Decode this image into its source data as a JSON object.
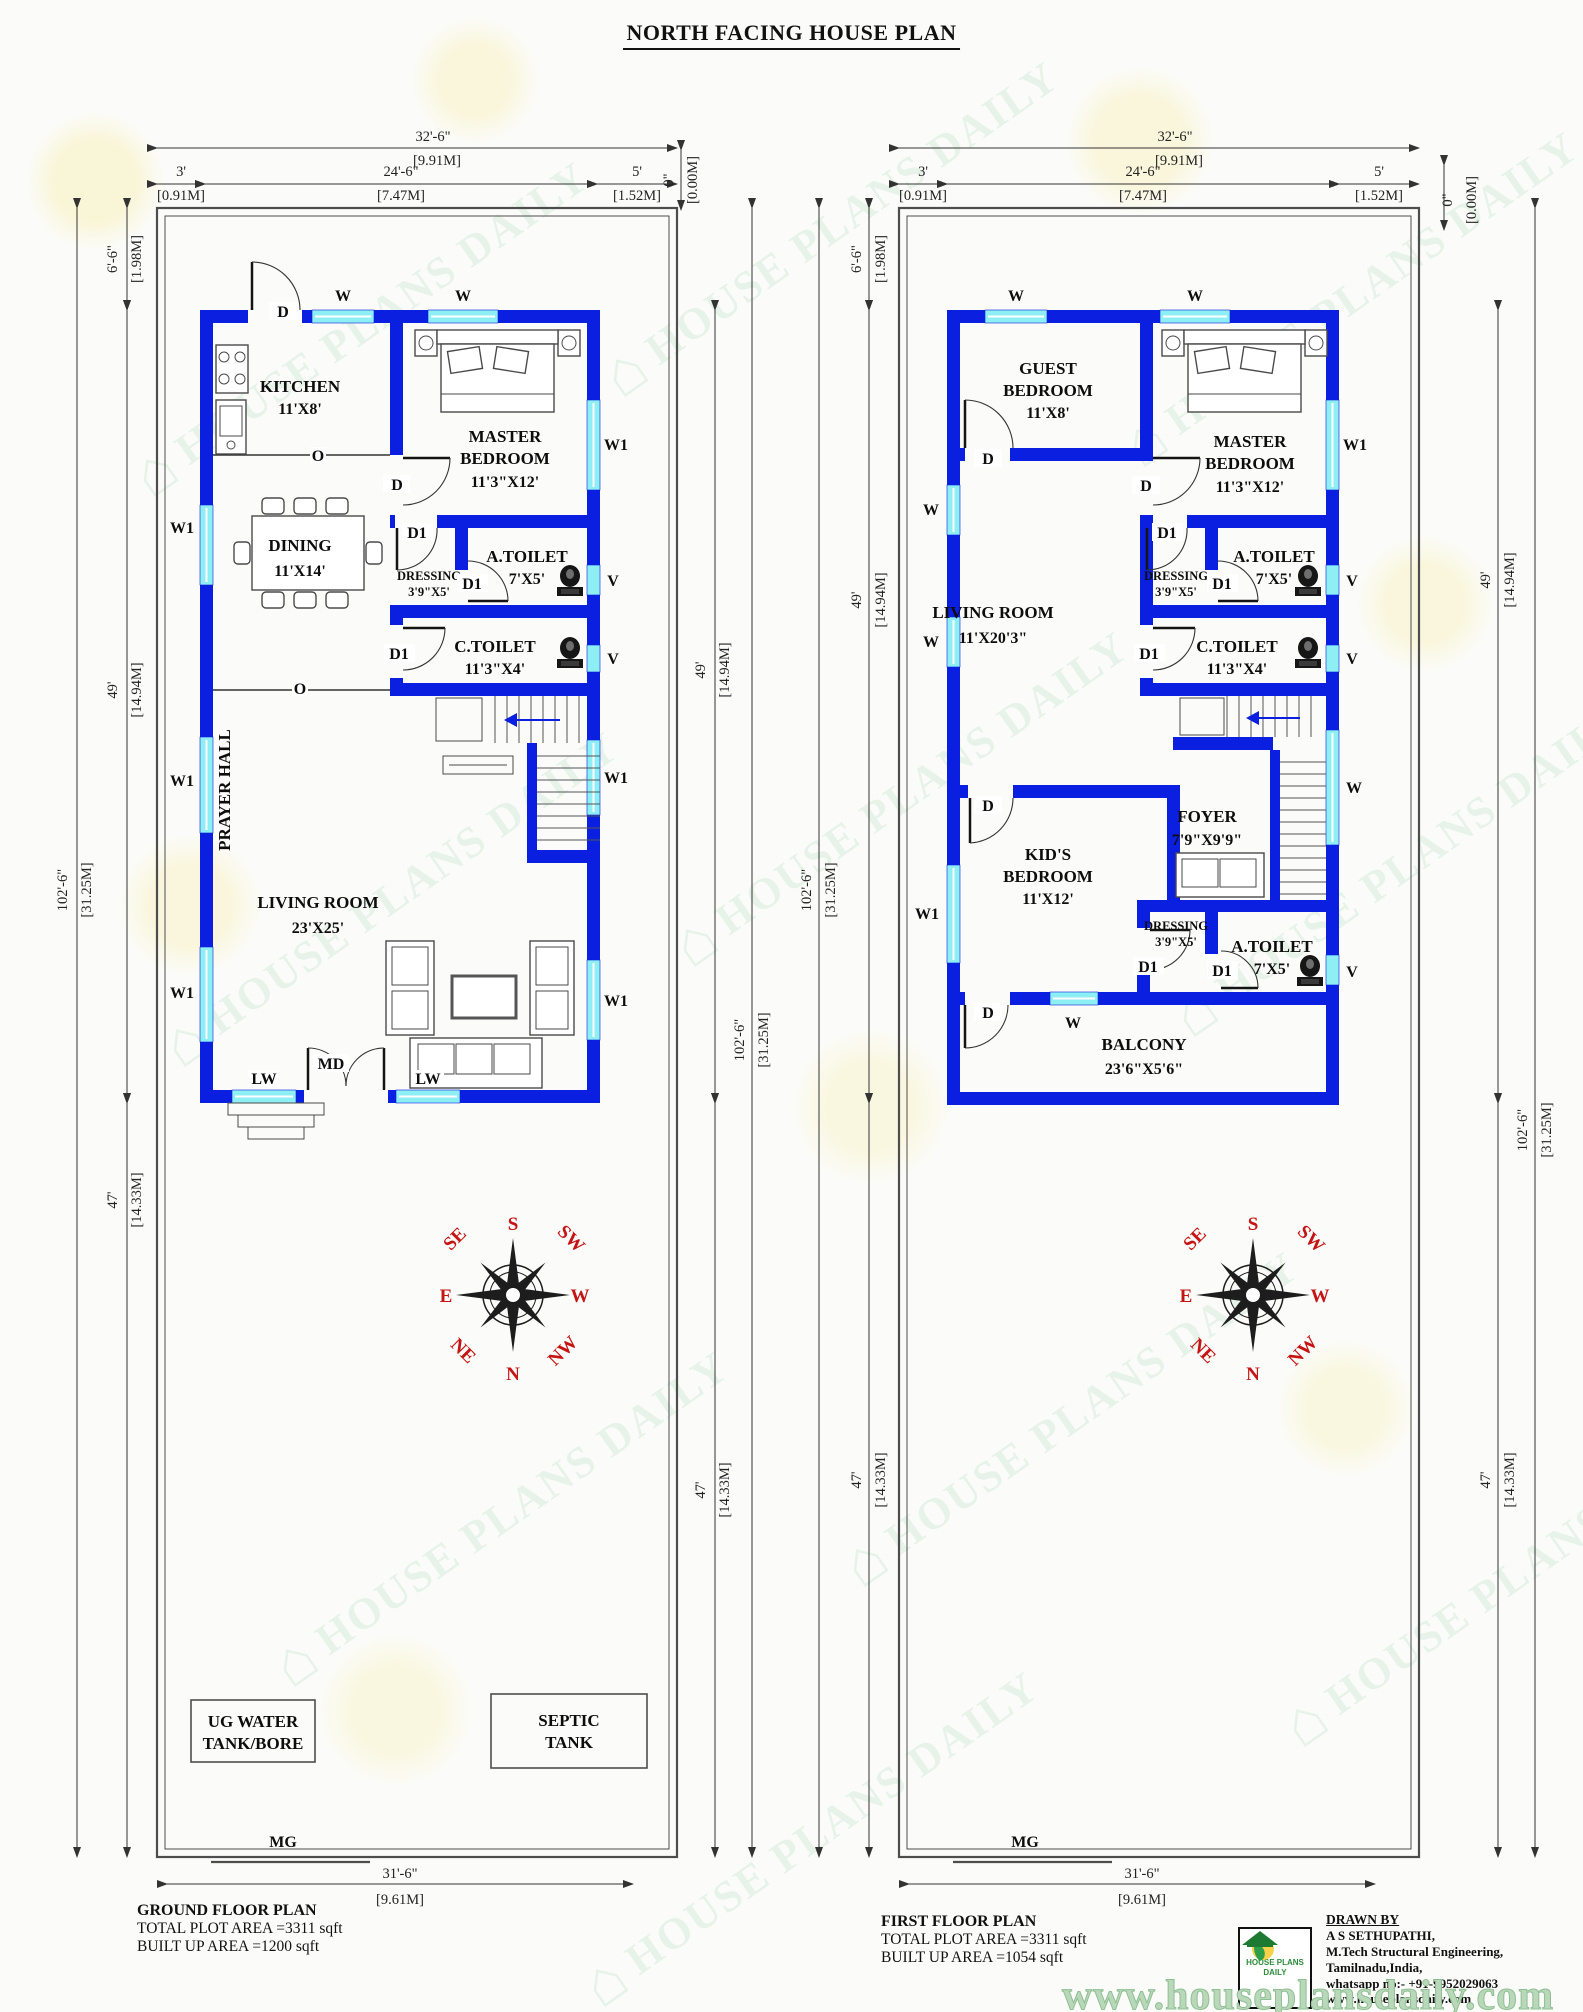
{
  "title": "NORTH FACING HOUSE PLAN",
  "colors": {
    "wall": "#0a1fe0",
    "win": "#8deef3",
    "compass": "#c41414",
    "brand": "#2f9e52",
    "bg": "#fbfcfa"
  },
  "icons": {
    "house": "⌂"
  },
  "brand": {
    "tile": "HOUSE PLANS DAILY"
  },
  "dims": {
    "total_ft": "32'-6\"",
    "total_m": "[9.91M]",
    "left_ft": "3'",
    "left_m": "[0.91M]",
    "mid_ft": "24'-6\"",
    "mid_m": "[7.47M]",
    "right_ft": "5'",
    "right_m": "[1.52M]",
    "setback_ft": "6'-6\"",
    "setback_m": "[1.98M]",
    "house_ft": "49'",
    "house_m": "[14.94M]",
    "plot_ft": "102'-6\"",
    "plot_m": "[31.25M]",
    "yard_ft": "47'",
    "yard_m": "[14.33M]",
    "zero_ft": "0\"",
    "zero_m": "[0.00M]",
    "bottom_ft": "31'-6\"",
    "bottom_m": "[9.61M]"
  },
  "markers": {
    "W": "W",
    "W1": "W1",
    "D": "D",
    "D1": "D1",
    "V": "V",
    "O": "O",
    "MD": "MD",
    "LW": "LW",
    "MG": "MG"
  },
  "ground": {
    "kitchen": [
      "KITCHEN",
      "11'X8'"
    ],
    "master": [
      "MASTER",
      "BEDROOM",
      "11'3\"X12'"
    ],
    "dining": [
      "DINING",
      "11'X14'"
    ],
    "dressing": [
      "DRESSING",
      "3'9\"X5'"
    ],
    "a_toilet": [
      "A.TOILET",
      "7'X5'"
    ],
    "c_toilet": [
      "C.TOILET",
      "11'3\"X4'"
    ],
    "prayer_hall": "PRAYER HALL",
    "living": [
      "LIVING ROOM",
      "23'X25'"
    ],
    "ug_tank": [
      "UG WATER",
      "TANK/BORE"
    ],
    "septic": [
      "SEPTIC",
      "TANK"
    ]
  },
  "first": {
    "guest": [
      "GUEST",
      "BEDROOM",
      "11'X8'"
    ],
    "master": [
      "MASTER",
      "BEDROOM",
      "11'3\"X12'"
    ],
    "living": [
      "LIVING ROOM",
      "11'X20'3\""
    ],
    "dressing1": [
      "DRESSING",
      "3'9\"X5'"
    ],
    "a_toilet1": [
      "A.TOILET",
      "7'X5'"
    ],
    "c_toilet": [
      "C.TOILET",
      "11'3\"X4'"
    ],
    "foyer": [
      "FOYER",
      "7'9\"X9'9\""
    ],
    "kids": [
      "KID'S",
      "BEDROOM",
      "11'X12'"
    ],
    "dressing2": [
      "DRESSING",
      "3'9\"X5'"
    ],
    "a_toilet2": [
      "A.TOILET",
      "7'X5'"
    ],
    "balcony": [
      "BALCONY",
      "23'6\"X5'6\""
    ]
  },
  "compass": {
    "n": "N",
    "ne": "NE",
    "e": "E",
    "se": "SE",
    "s": "S",
    "sw": "SW",
    "w": "W",
    "nw": "NW"
  },
  "footer": {
    "ground_title": "GROUND FLOOR PLAN",
    "ground_plot": "TOTAL PLOT AREA =3311 sqft",
    "ground_built": "BUILT UP AREA =1200 sqft",
    "first_title": "FIRST  FLOOR PLAN",
    "first_plot": "TOTAL PLOT AREA =3311 sqft",
    "first_built": "BUILT UP AREA =1054 sqft",
    "drawn_by": "DRAWN BY",
    "author": "A S SETHUPATHI,",
    "qualification": "M.Tech Structural Engineering,",
    "location": "Tamilnadu,India,",
    "whatsapp": "whatsapp no:- +91-9952029063",
    "website": "www.houseplansdaily.com",
    "watermark": "www.houseplansdaily.com",
    "logo_top": "HOUSE PLANS",
    "logo_bottom": "DAILY"
  }
}
